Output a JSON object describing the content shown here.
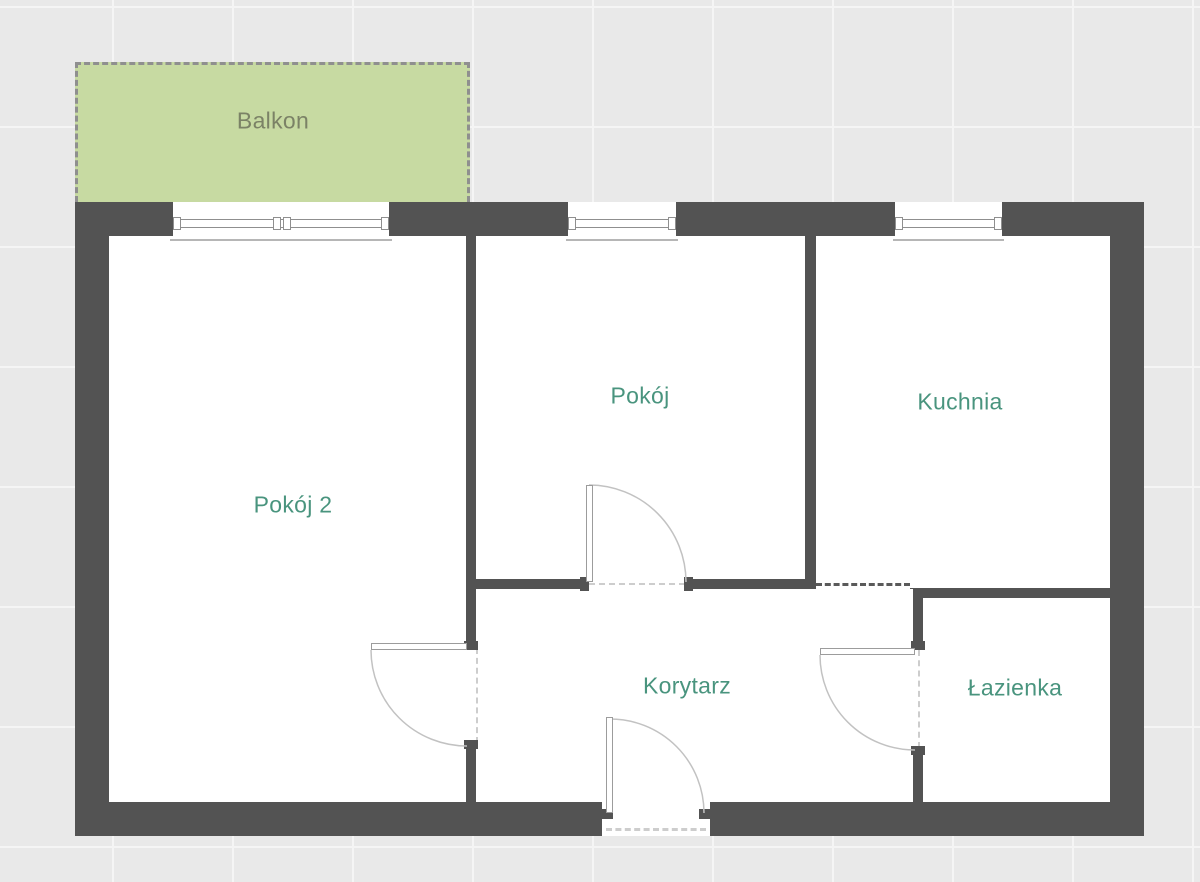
{
  "floorplan": {
    "rooms": {
      "balkon": {
        "label": "Balkon"
      },
      "pokoj2": {
        "label": "Pokój 2"
      },
      "pokoj": {
        "label": "Pokój"
      },
      "kuchnia": {
        "label": "Kuchnia"
      },
      "korytarz": {
        "label": "Korytarz"
      },
      "lazienka": {
        "label": "Łazienka"
      }
    },
    "colors": {
      "wall": "#535353",
      "room_fill": "#ffffff",
      "balcony_fill": "#c7daa2",
      "balcony_label": "#7b8266",
      "room_label": "#49947e",
      "background": "#e9e9e9",
      "grid_line": "#f5f5f5",
      "door_line": "#c2c2c2",
      "door_leaf_border": "#9c9c9c",
      "window_frame": "#8f8f8f",
      "sill_line": "#b6b6b6",
      "passage_dash": "#5a5a5a",
      "opening_dash": "#cdcdcd",
      "balcony_dash": "#8f8f8f"
    }
  }
}
